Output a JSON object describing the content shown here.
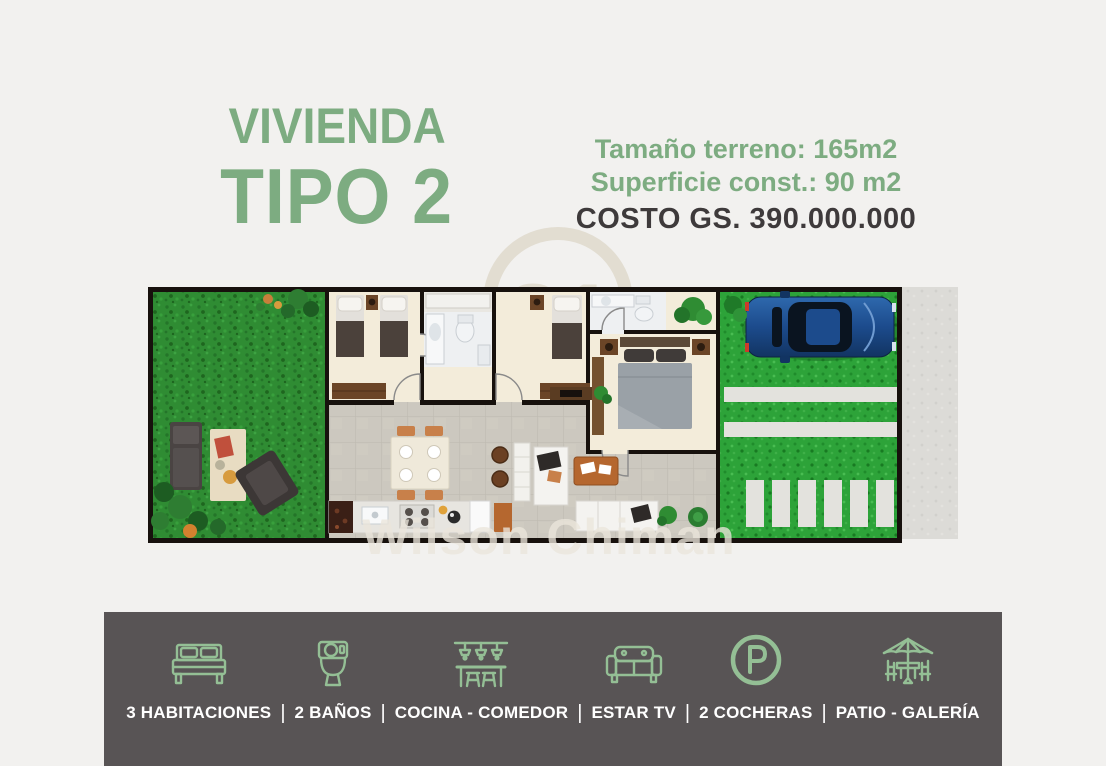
{
  "header": {
    "title_line1": "VIVIENDA",
    "title_line2": "TIPO 2",
    "land_size": "Tamaño terreno: 165m2",
    "built_area": "Superficie const.: 90 m2",
    "cost": "COSTO GS. 390.000.000"
  },
  "watermarks": {
    "logo_number": "21",
    "agent_name": "Wilson Chiman"
  },
  "floor_plan": {
    "alt": "Top-down floor plan: left garden with lounge furniture, three bedrooms, two bathrooms, kitchen-dining-living area, green driveway with blue car, paving strips and sidewalk"
  },
  "features": [
    {
      "icon": "bed-icon",
      "label": "3 HABITACIONES"
    },
    {
      "icon": "toilet-icon",
      "label": "2 BAÑOS"
    },
    {
      "icon": "kitchen-dining-icon",
      "label": "COCINA - COMEDOR"
    },
    {
      "icon": "sofa-icon",
      "label": "ESTAR TV"
    },
    {
      "icon": "parking-icon",
      "label": "2 COCHERAS"
    },
    {
      "icon": "patio-icon",
      "label": "PATIO - GALERÍA"
    }
  ],
  "separator": "|",
  "colors": {
    "accent_green": "#7dac81",
    "icon_green": "#94bf95",
    "cost_text": "#3e3a3b",
    "footer_background": "#585455",
    "page_background": "#f2f1ef",
    "car_blue": "#1c4b8c",
    "grass_green": "#2f8c33"
  }
}
